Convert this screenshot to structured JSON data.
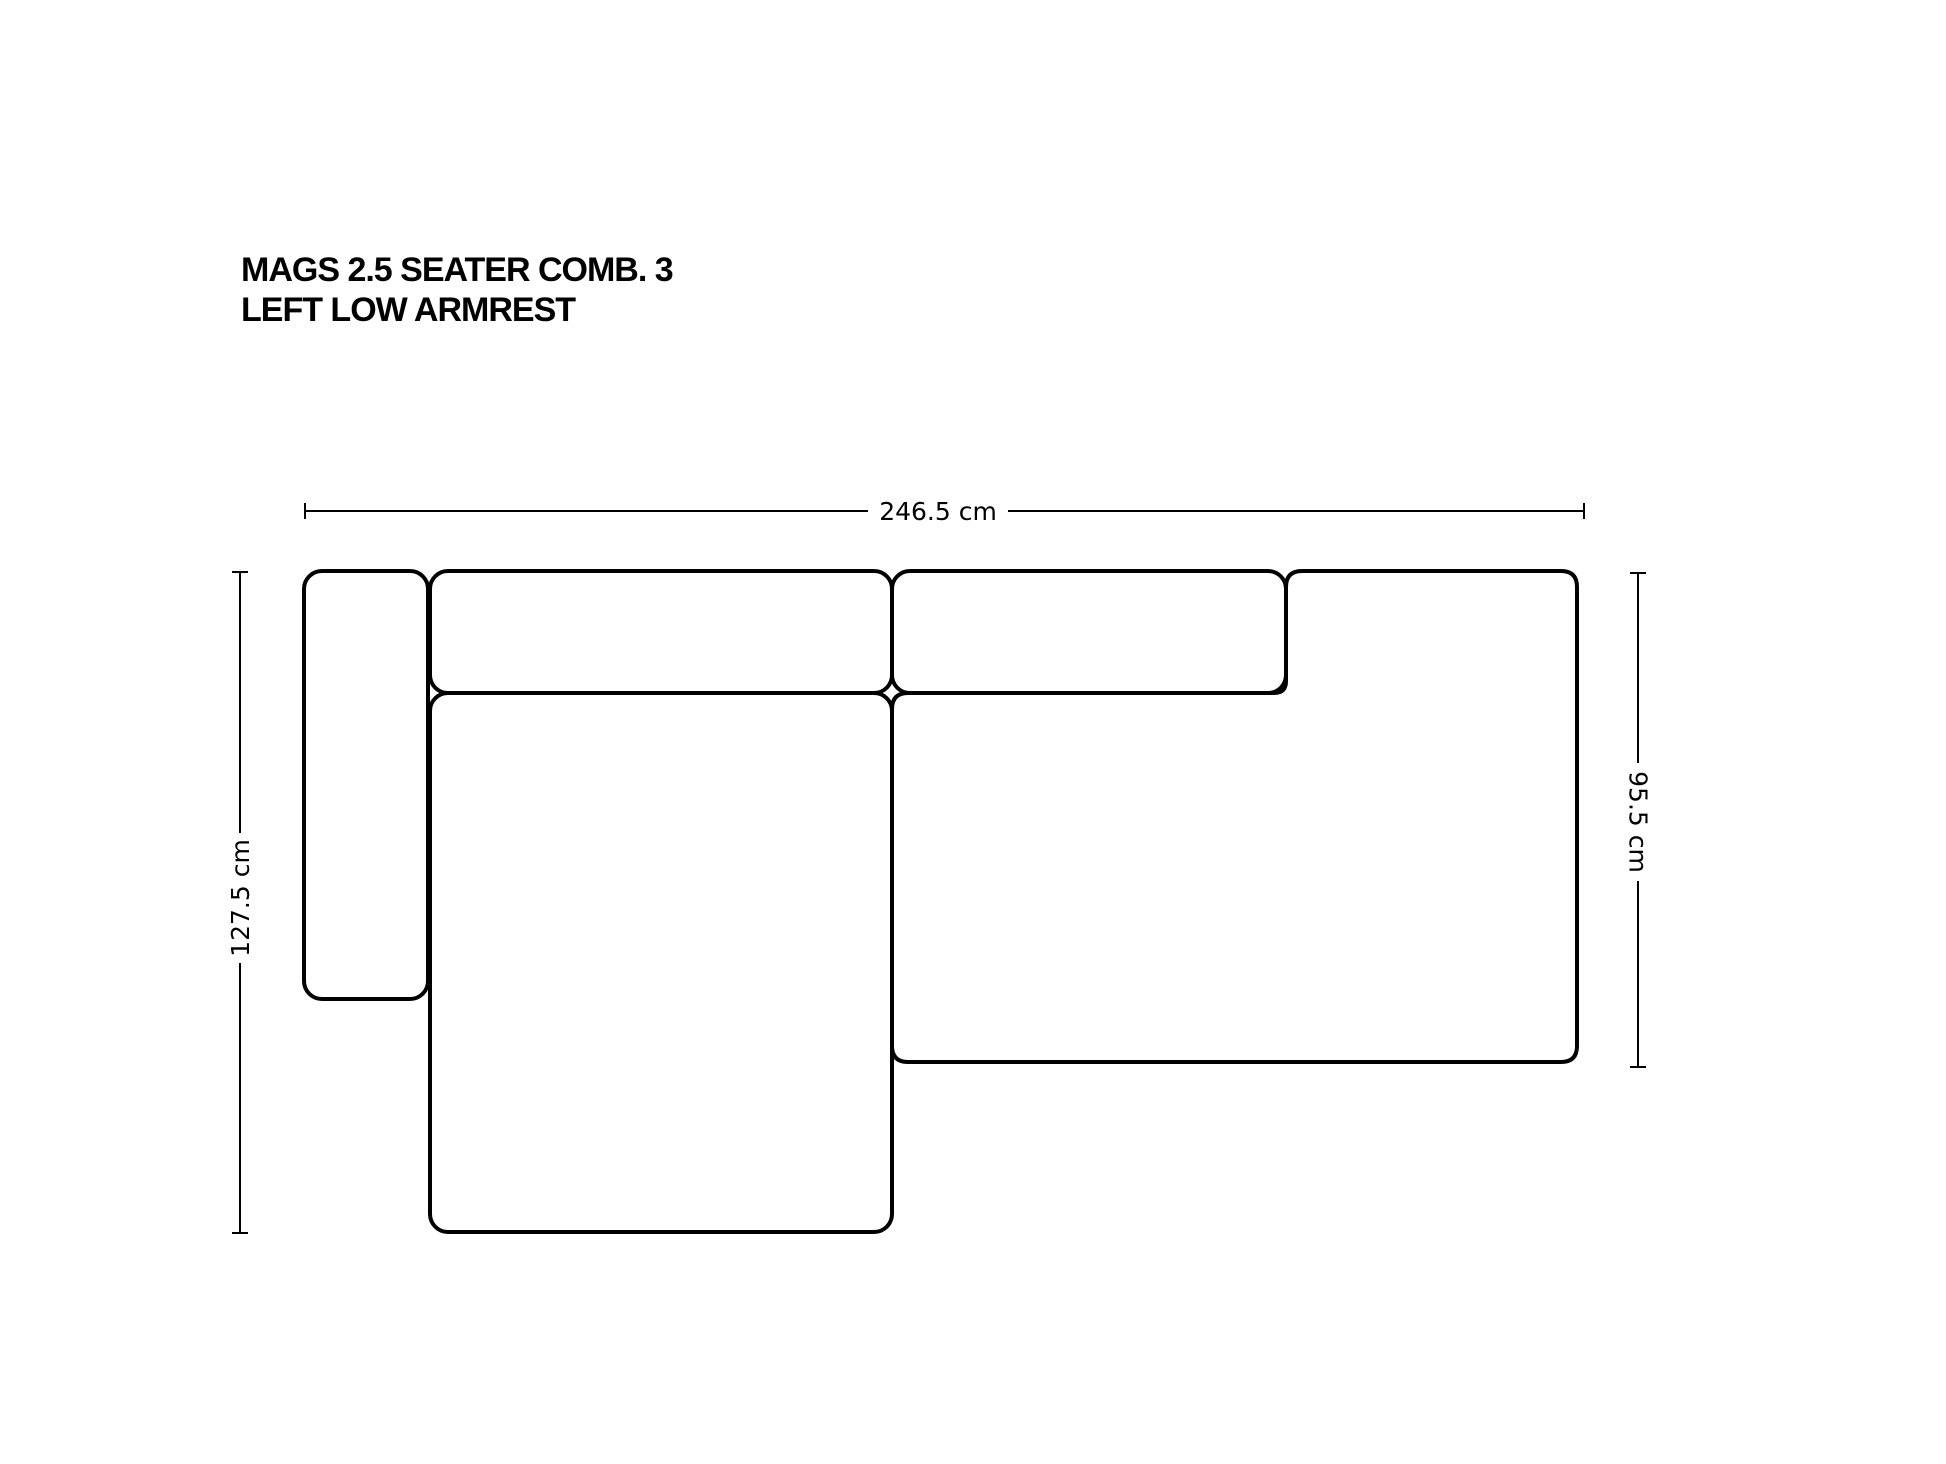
{
  "title": {
    "line1": "MAGS 2.5 SEATER COMB. 3",
    "line2": "LEFT LOW ARMREST"
  },
  "dimensions": {
    "overall_width": {
      "label": "246.5 cm"
    },
    "left_depth": {
      "label": "127.5 cm"
    },
    "right_depth": {
      "label": "95.5 cm"
    }
  },
  "colors": {
    "line": "#000000",
    "background": "#ffffff"
  }
}
